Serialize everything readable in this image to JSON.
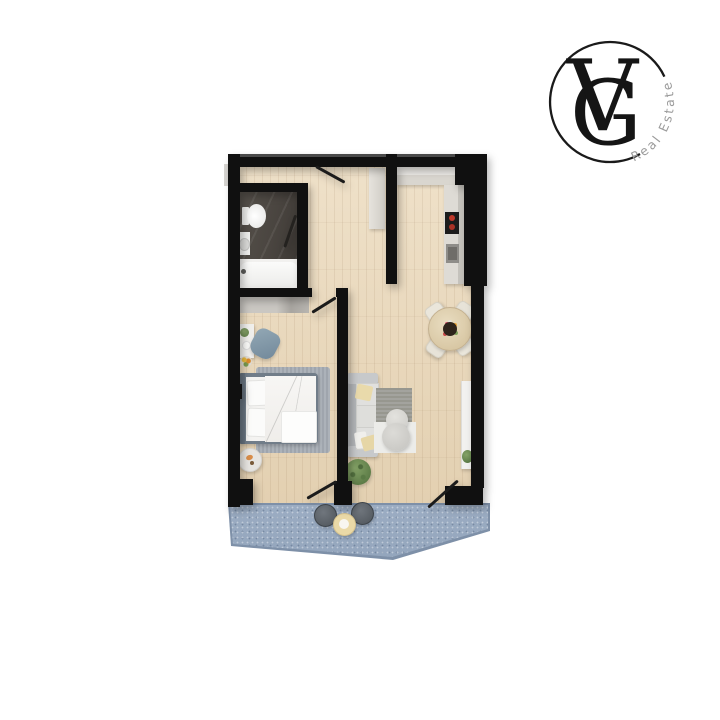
{
  "logo": {
    "letter_v": "V",
    "letter_g": "G",
    "tagline": "Real Estate",
    "monogram_color": "#151515",
    "ring_color": "#1a1a1a",
    "tagline_color": "#9b9b9b"
  },
  "palette": {
    "background": "#ffffff",
    "wall": "#101010",
    "wood_floor": "#e8d6b8",
    "bathroom_marble": "#4a4540",
    "balcony_floor": "#98aac1",
    "kitchen_cabinet": "#d9d6d0",
    "counter_marble": "#eceae6",
    "sofa_gray": "#c7c9cb",
    "cushion_white": "#e0e0de",
    "accent_pillow_yellow": "#e9daab",
    "bed_frame_gray": "#717d89",
    "bedding_white": "#f4f3f1",
    "rug_gray": "#a7adb4",
    "dining_table_wood": "#dcc9a3",
    "chair_cream": "#eae6db",
    "cooktop_black": "#1c1c1c",
    "burner_red": "#c0392b",
    "plant_green": "#5d7c47",
    "stool_dark": "#565c63",
    "balcony_table_cream": "#ead9a7"
  },
  "scene": {
    "rooms": [
      "entry-hall",
      "bathroom",
      "kitchen",
      "living-dining-room",
      "bedroom",
      "balcony"
    ],
    "furniture": [
      "toilet",
      "sink",
      "bathtub",
      "hall-closet",
      "kitchen-counter",
      "cooktop",
      "kitchen-sink",
      "dining-table",
      "dining-chairs",
      "sofa",
      "living-rug",
      "poufs",
      "floor-plant",
      "tv-console",
      "console-plant",
      "wardrobe",
      "desk",
      "desk-chair",
      "bed",
      "bedroom-rug",
      "side-table",
      "balcony-stools",
      "balcony-table"
    ],
    "doors": [
      "entrance-door",
      "bathroom-door",
      "bedroom-door",
      "bedroom-balcony-door",
      "living-balcony-door"
    ]
  }
}
